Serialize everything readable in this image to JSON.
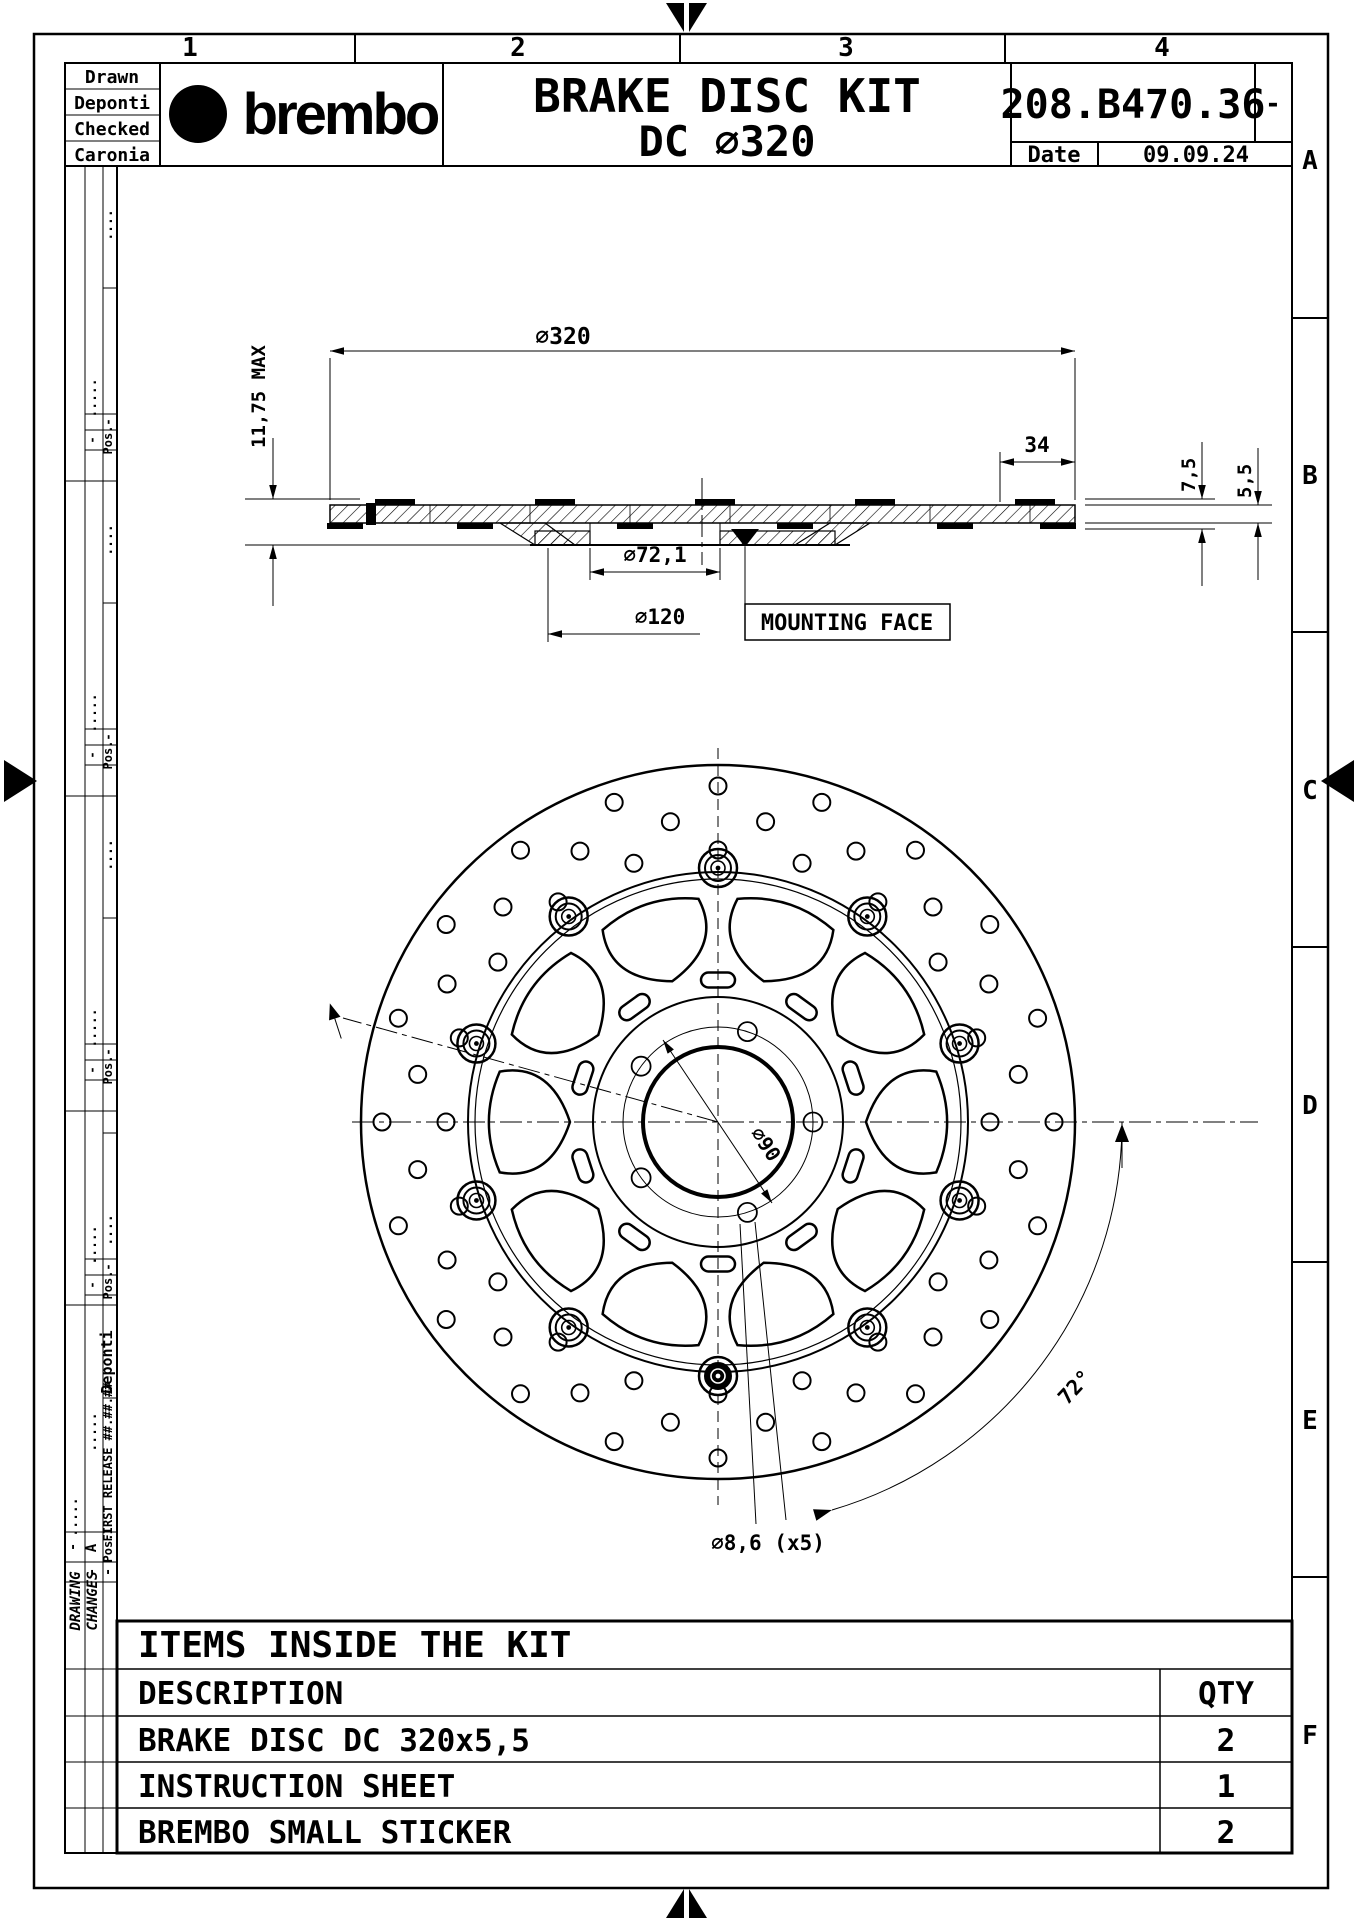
{
  "zones": {
    "top": [
      "1",
      "2",
      "3",
      "4"
    ],
    "right": [
      "A",
      "B",
      "C",
      "D",
      "E",
      "F"
    ]
  },
  "title_block": {
    "labels": [
      "Drawn",
      "Deponti",
      "Checked",
      "Caronia"
    ],
    "logo_mark": "b",
    "logo_text": "brembo",
    "title_line1": "BRAKE DISC KIT",
    "title_line2": "DC ∅320",
    "part_number": "208.B470.36",
    "revision": "-",
    "date_label": "Date",
    "date_value": "09.09.24"
  },
  "dimensions": {
    "outer_diameter": "∅320",
    "offset34": "34",
    "max_width": "11,75 MAX",
    "thick75": "7,5",
    "thick55": "5,5",
    "bore": "∅72,1",
    "bc120": "∅120",
    "mounting": "MOUNTING FACE",
    "bc90": "∅90",
    "holes86": "∅8,6 (x5)",
    "angle72": "72°"
  },
  "revision_strip": {
    "pos_label": "Pos.",
    "dash": "-",
    "dots4": "....",
    "dots5": ".....",
    "letter": "A",
    "author": "Deponti",
    "first_release": "FIRST RELEASE ##.##.##",
    "drawing": "DRAWING",
    "changes": "CHANGES"
  },
  "kit_table": {
    "title": "ITEMS INSIDE THE KIT",
    "desc_header": "DESCRIPTION",
    "qty_header": "QTY",
    "rows": [
      {
        "description": "BRAKE DISC DC 320x5,5",
        "qty": "2"
      },
      {
        "description": "INSTRUCTION SHEET",
        "qty": "1"
      },
      {
        "description": "BREMBO SMALL STICKER",
        "qty": "2"
      }
    ]
  }
}
